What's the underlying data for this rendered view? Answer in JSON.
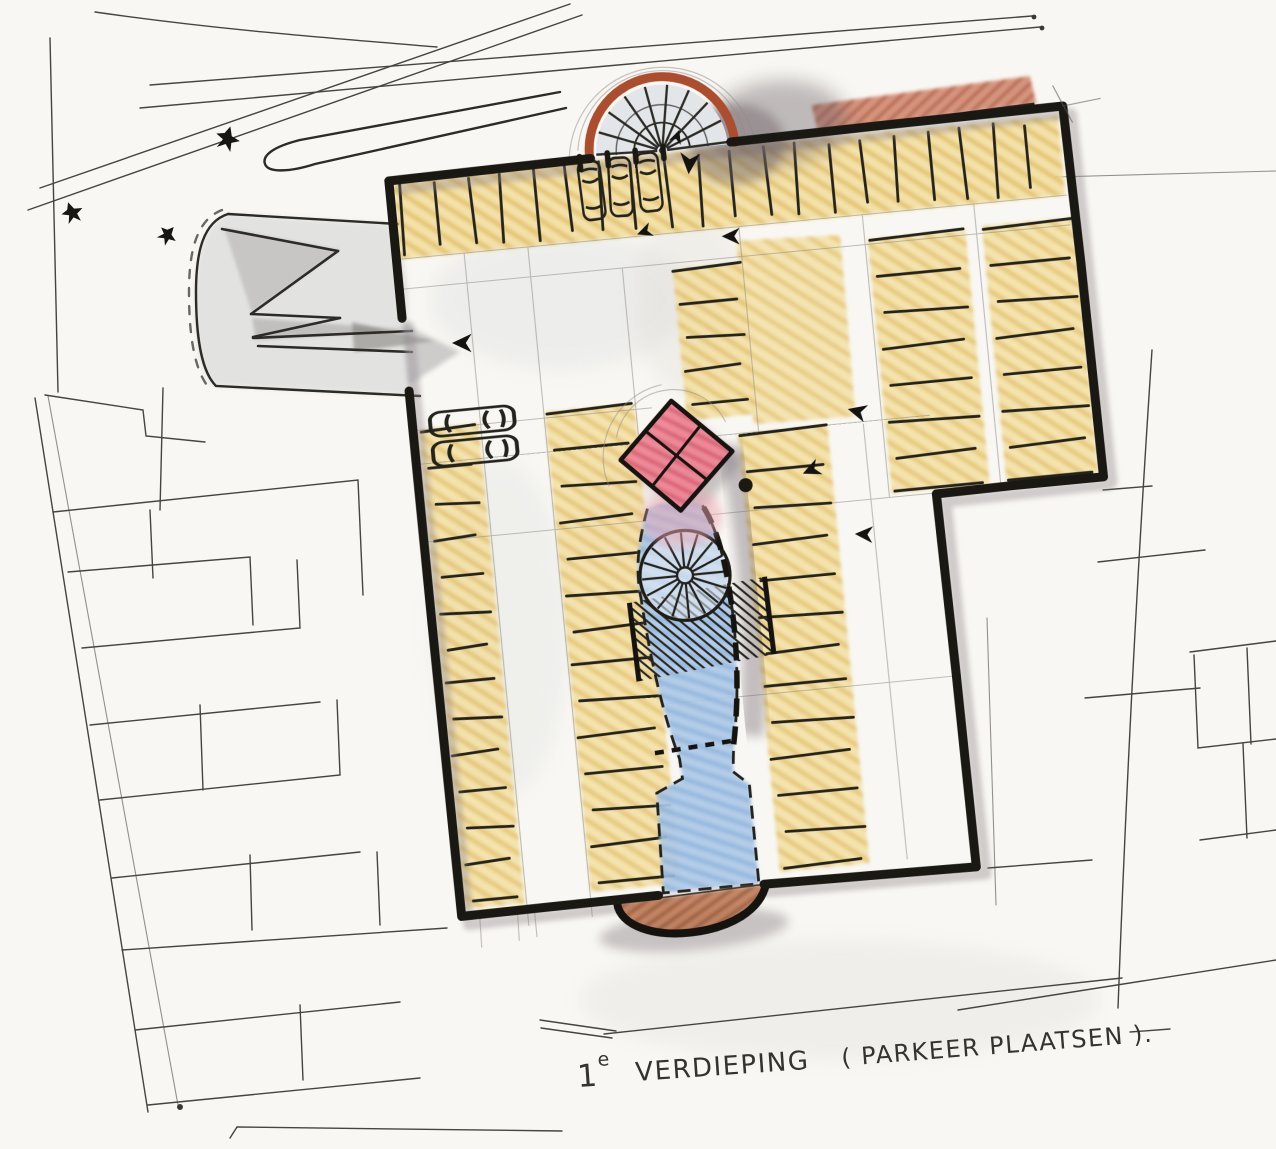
{
  "caption": {
    "floor_number": "1",
    "floor_ordinal": "e",
    "floor_label": "VERDIEPING",
    "qualifier": "( PARKEER PLAATSEN )."
  },
  "plan": {
    "type": "hand-drawn architectural floor plan sketch (colored pencil and ink)",
    "level": "1e verdieping (first floor)",
    "use": "parkeerplaatsen (parking spaces)",
    "elements": {
      "half_round_ramp": "semicircular spiral ramp on top wall",
      "street_ramp": "switchback entry ramp from street at left",
      "core": "red diamond elevator core",
      "stair_void": "blue light well with spiral stair and hatched landing",
      "canopy": "brown entrance canopy at bottom wall",
      "parking_strips": 7,
      "cars": 5,
      "traffic_arrows": 7,
      "trees": 3
    }
  },
  "colors": {
    "paper": "#f8f7f3",
    "ink": "#1b1a15",
    "pencil": "#45443f",
    "parking_yellow": "#f2dd9b",
    "yellow_hatch": "#e2bd5e",
    "core_pink": "#ee8695",
    "core_hatch": "#d75a6e",
    "void_blue": "#adc9e8",
    "void_hatch": "#8fb4dd",
    "canopy_brown": "#b96f4c",
    "ramp_rim_red": "#ac4d2e",
    "neighbor_red": "#d28a72",
    "shadow_gray": "#8d8388"
  }
}
